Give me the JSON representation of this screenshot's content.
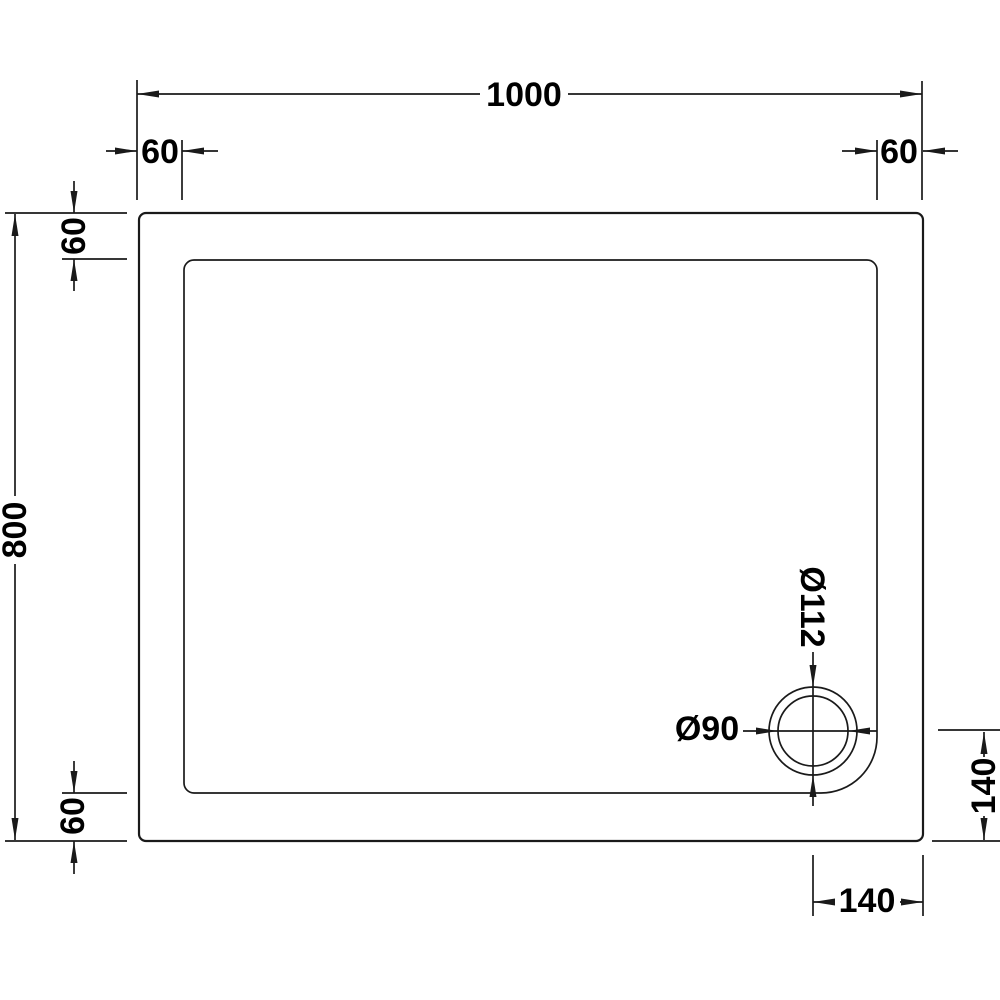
{
  "diagram": {
    "description": "Rectangular shower tray technical plan drawing with drain",
    "labels": {
      "overall_width": "1000",
      "overall_depth": "800",
      "edge_inset_top_left": "60",
      "edge_inset_top_right": "60",
      "edge_inset_left_top": "60",
      "edge_inset_left_bottom": "60",
      "drain_outer_diameter": "Ø112",
      "drain_inner_diameter": "Ø90",
      "drain_center_from_right": "140",
      "drain_center_from_bottom": "140"
    },
    "measurements_mm": {
      "overall_width": 1000,
      "overall_depth": 800,
      "rim_inset": 60,
      "drain_outer_diameter": 112,
      "drain_inner_diameter": 90,
      "drain_center_from_right": 140,
      "drain_center_from_bottom": 140
    },
    "colors": {
      "line": "#1a1a1a",
      "text": "#000000",
      "background": "#ffffff"
    }
  }
}
